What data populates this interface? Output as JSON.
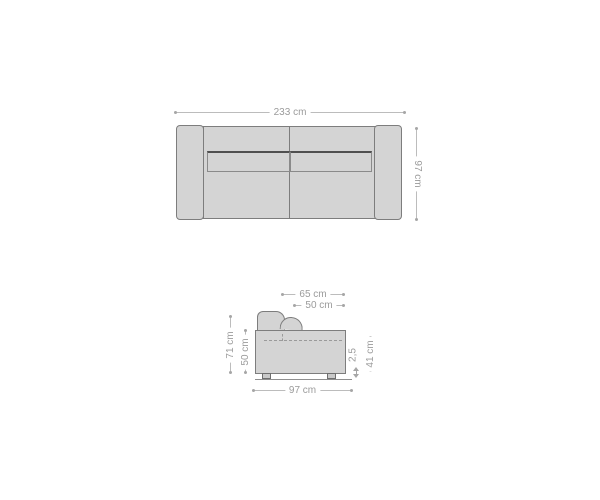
{
  "figure": {
    "type": "product-dimension-diagram",
    "subject": "sofa",
    "views": [
      "top",
      "side"
    ]
  },
  "colors": {
    "background": "#ffffff",
    "body_fill": "#d4d4d4",
    "body_stroke": "#7d7d7d",
    "cushion_top_stroke": "#4f4f4f",
    "dashed_line": "#9a9a9a",
    "dim_line": "#bcbcbc",
    "dim_text": "#9b9b9b",
    "leg_fill": "#c9c9c9",
    "leg_stroke": "#6e6e6e",
    "floor_line": "#8f8f8f"
  },
  "top_view": {
    "overall_width": "233 cm",
    "overall_depth": "97 cm"
  },
  "side_view": {
    "seat_depth_outer": "65 cm",
    "seat_depth_inner": "50 cm",
    "total_height": "71 cm",
    "body_height": "50 cm",
    "total_depth": "97 cm",
    "clearance": "2,5",
    "seat_height": "41 cm"
  }
}
